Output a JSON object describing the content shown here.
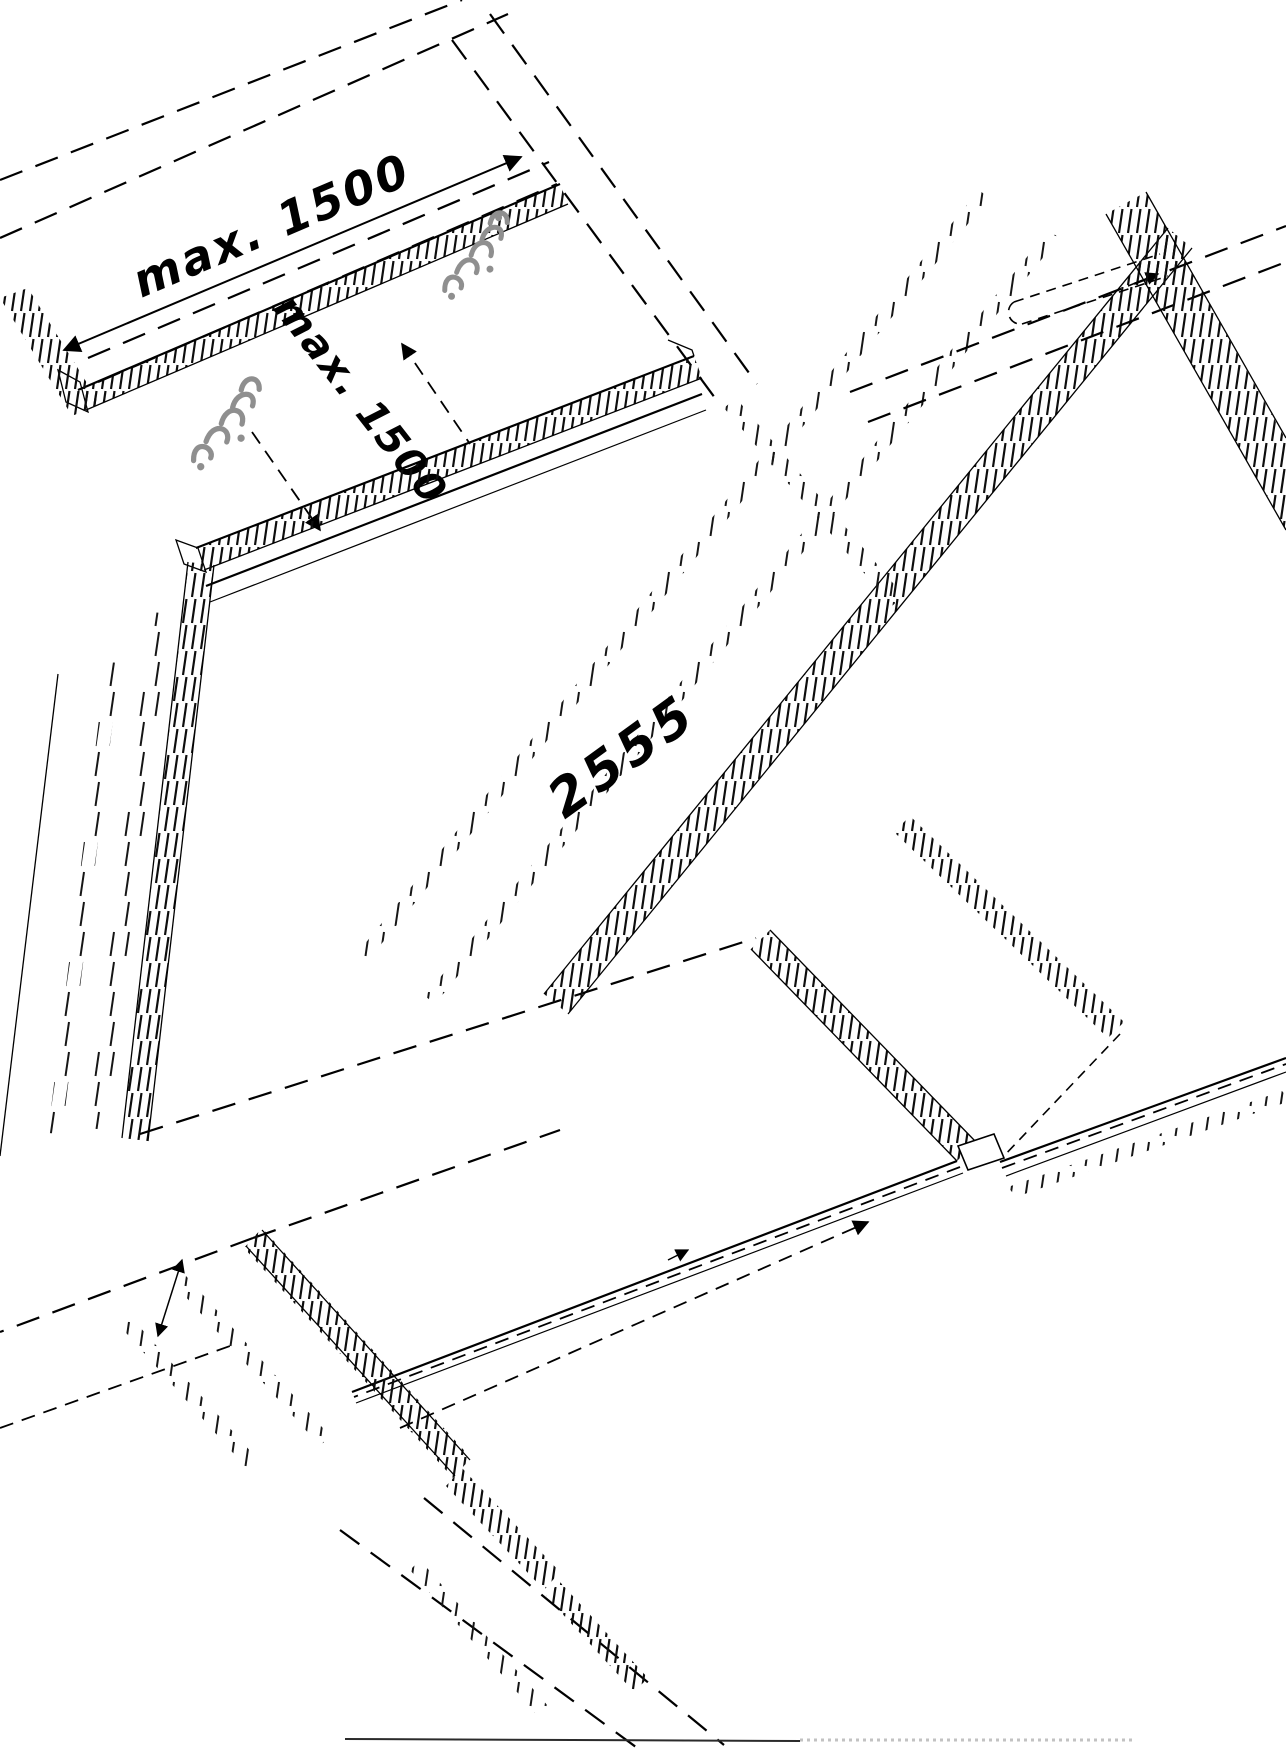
{
  "drawing": {
    "background": "#ffffff",
    "line_color": "#000000",
    "fastener_color": "#8f8f8f",
    "baseline_dotted_color": "#c2c2c2",
    "labels": {
      "fastener_spacing_top": "max. 1500",
      "rail_spacing_side": "max. 1500",
      "panel_width": "2555"
    },
    "icons": {
      "fastener_mark": "fastener-mark-icon",
      "arrowhead": "arrowhead-icon"
    }
  }
}
